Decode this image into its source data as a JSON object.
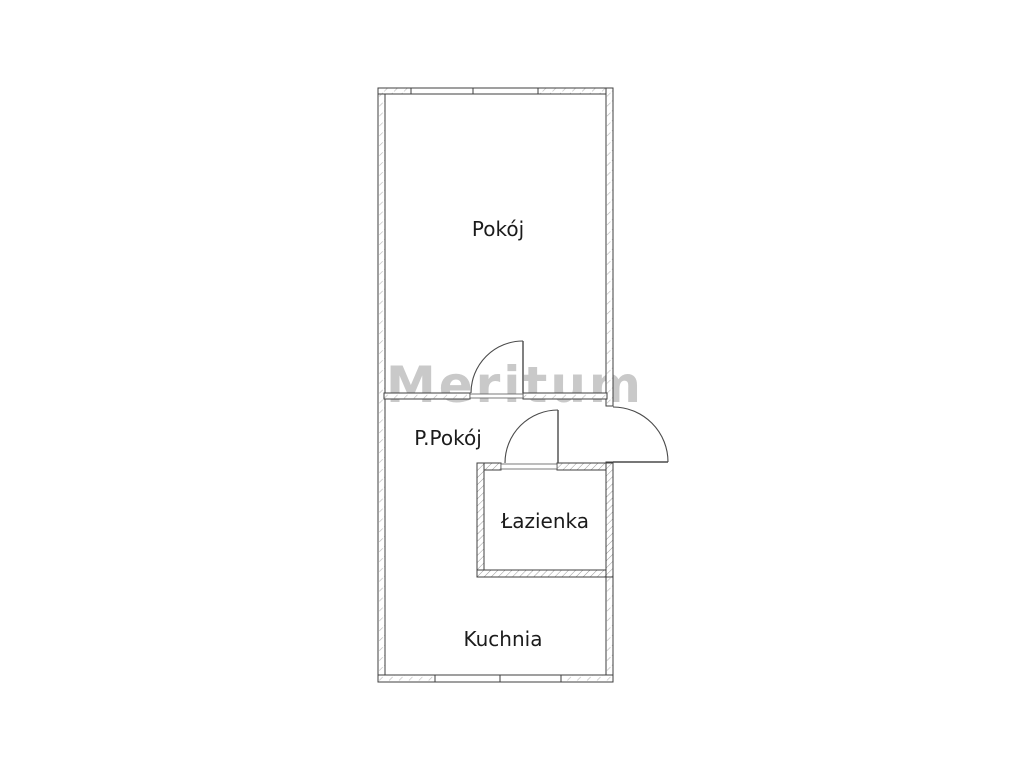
{
  "floor_plan": {
    "watermark": "Meritum",
    "rooms": [
      {
        "id": "pokoj",
        "label": "Pokój"
      },
      {
        "id": "p-pokoj",
        "label": "P.Pokój"
      },
      {
        "id": "lazienka",
        "label": "Łazienka"
      },
      {
        "id": "kuchnia",
        "label": "Kuchnia"
      }
    ],
    "features": {
      "doors": [
        "pokoj-door",
        "lazienka-door",
        "entry-door"
      ],
      "windows": [
        "top-window",
        "bottom-window"
      ]
    },
    "colors": {
      "background": "#ffffff",
      "wall_line": "#3f3f3f",
      "hatch_light": "#b8b8b8",
      "hatch_dense": "#9a9a9a",
      "label_text": "#1b1b1b",
      "watermark": "#c9c9c9"
    }
  }
}
